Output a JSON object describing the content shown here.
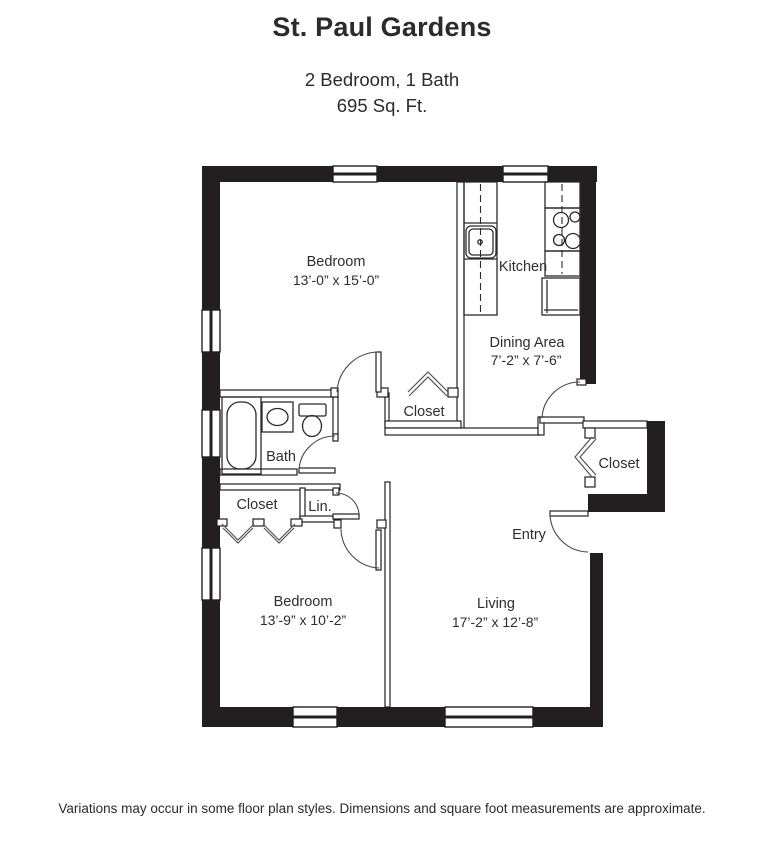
{
  "header": {
    "title": "St. Paul Gardens",
    "subtitle_line1": "2 Bedroom, 1 Bath",
    "subtitle_line2": "695 Sq. Ft."
  },
  "floor_plan": {
    "rooms": {
      "bedroom_1": {
        "label": "Bedroom",
        "dimensions": "13’-0” x 15’-0”"
      },
      "kitchen": {
        "label": "Kitchen"
      },
      "dining_area": {
        "label": "Dining Area",
        "dimensions": "7’-2” x 7’-6”"
      },
      "bedroom_1_closet": {
        "label": "Closet"
      },
      "bath": {
        "label": "Bath"
      },
      "bedroom_2_closet": {
        "label": "Closet"
      },
      "linen_closet": {
        "label": "Lin."
      },
      "entry_closet": {
        "label": "Closet"
      },
      "entry": {
        "label": "Entry"
      },
      "bedroom_2": {
        "label": "Bedroom",
        "dimensions": "13’-9” x 10’-2”"
      },
      "living": {
        "label": "Living",
        "dimensions": "17’-2” x 12’-8”"
      }
    },
    "fixtures": [
      "bathtub",
      "bathroom-sink",
      "toilet",
      "kitchen-sink",
      "stove",
      "refrigerator"
    ],
    "colors": {
      "walls": "#231f20",
      "lines": "#2b2b2b",
      "text": "#2e2d33",
      "background": "#ffffff"
    }
  },
  "footer": {
    "disclaimer": "Variations may occur in some floor plan styles. Dimensions and square foot measurements are approximate."
  }
}
